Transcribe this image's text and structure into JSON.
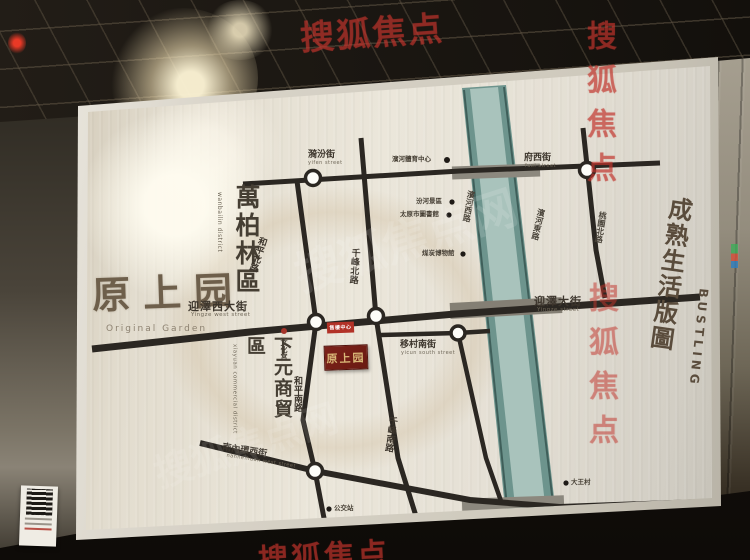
{
  "photo": {
    "watermark_red": "搜狐焦点",
    "watermark_white": "搜狐焦点网"
  },
  "brand": {
    "title": "原上园",
    "title_en": "Original Garden",
    "slogan": "成熟生活版圖",
    "slogan_en": "BUSTLING"
  },
  "districts": {
    "wanbailin": "萬柏林區",
    "wanbailin_en": "wanbailin district",
    "xiayuan": "下元商貿區",
    "xiayuan_en": "xiayuan commercial district"
  },
  "marker": {
    "plaque": "原上园",
    "sales_tag": "售樓中心"
  },
  "streets": {
    "yifen": "漪汾街",
    "yifen_en": "yifen street",
    "fuxi": "府西街",
    "fuxi_en": "fuxi street",
    "yingze_west": "迎澤西大街",
    "yingze_west_en": "Yingze west street",
    "yingze": "迎澤大街",
    "yingze_en": "Yingze street",
    "heping_n": "和平北路",
    "qianfeng_n": "千峰北路",
    "heping_s": "和平南路",
    "qianfeng_s": "千峰南路",
    "yicun": "移村南街",
    "yicun_en": "yicun south street",
    "nanneihuan": "南內環西街",
    "nanneihuan_en": "nanneihuan west street",
    "binhe_w": "濱河西路",
    "binhe_e": "濱河東路",
    "taoyuan": "桃園北路"
  },
  "landmarks": {
    "sports_center": "濱河體育中心",
    "fenhe_scenic": "汾河景區",
    "library": "太原市圖書館",
    "coal_museum": "煤炭博物館",
    "culture_palace": "文化宮",
    "bus_stop": "公交站",
    "dawang_village": "大王村",
    "nanneihuan_bridge": "南內環橋",
    "fenhe_park": "汾河公園"
  },
  "colors": {
    "river_center": "#a9c3bc",
    "river_edge": "#5d8a85",
    "road": "#2b2722",
    "plaque_bg": "#7a2018",
    "plaque_text": "#d9b878",
    "tag_red": "#b23227",
    "watermark_red": "#c1342c"
  },
  "mosaic_palette": [
    "#d94f3a",
    "#e98c2a",
    "#3fae5a",
    "#2f7fc1",
    "#35b3a0",
    "#d4486e",
    "#8bc53f",
    "#f0c13a"
  ]
}
